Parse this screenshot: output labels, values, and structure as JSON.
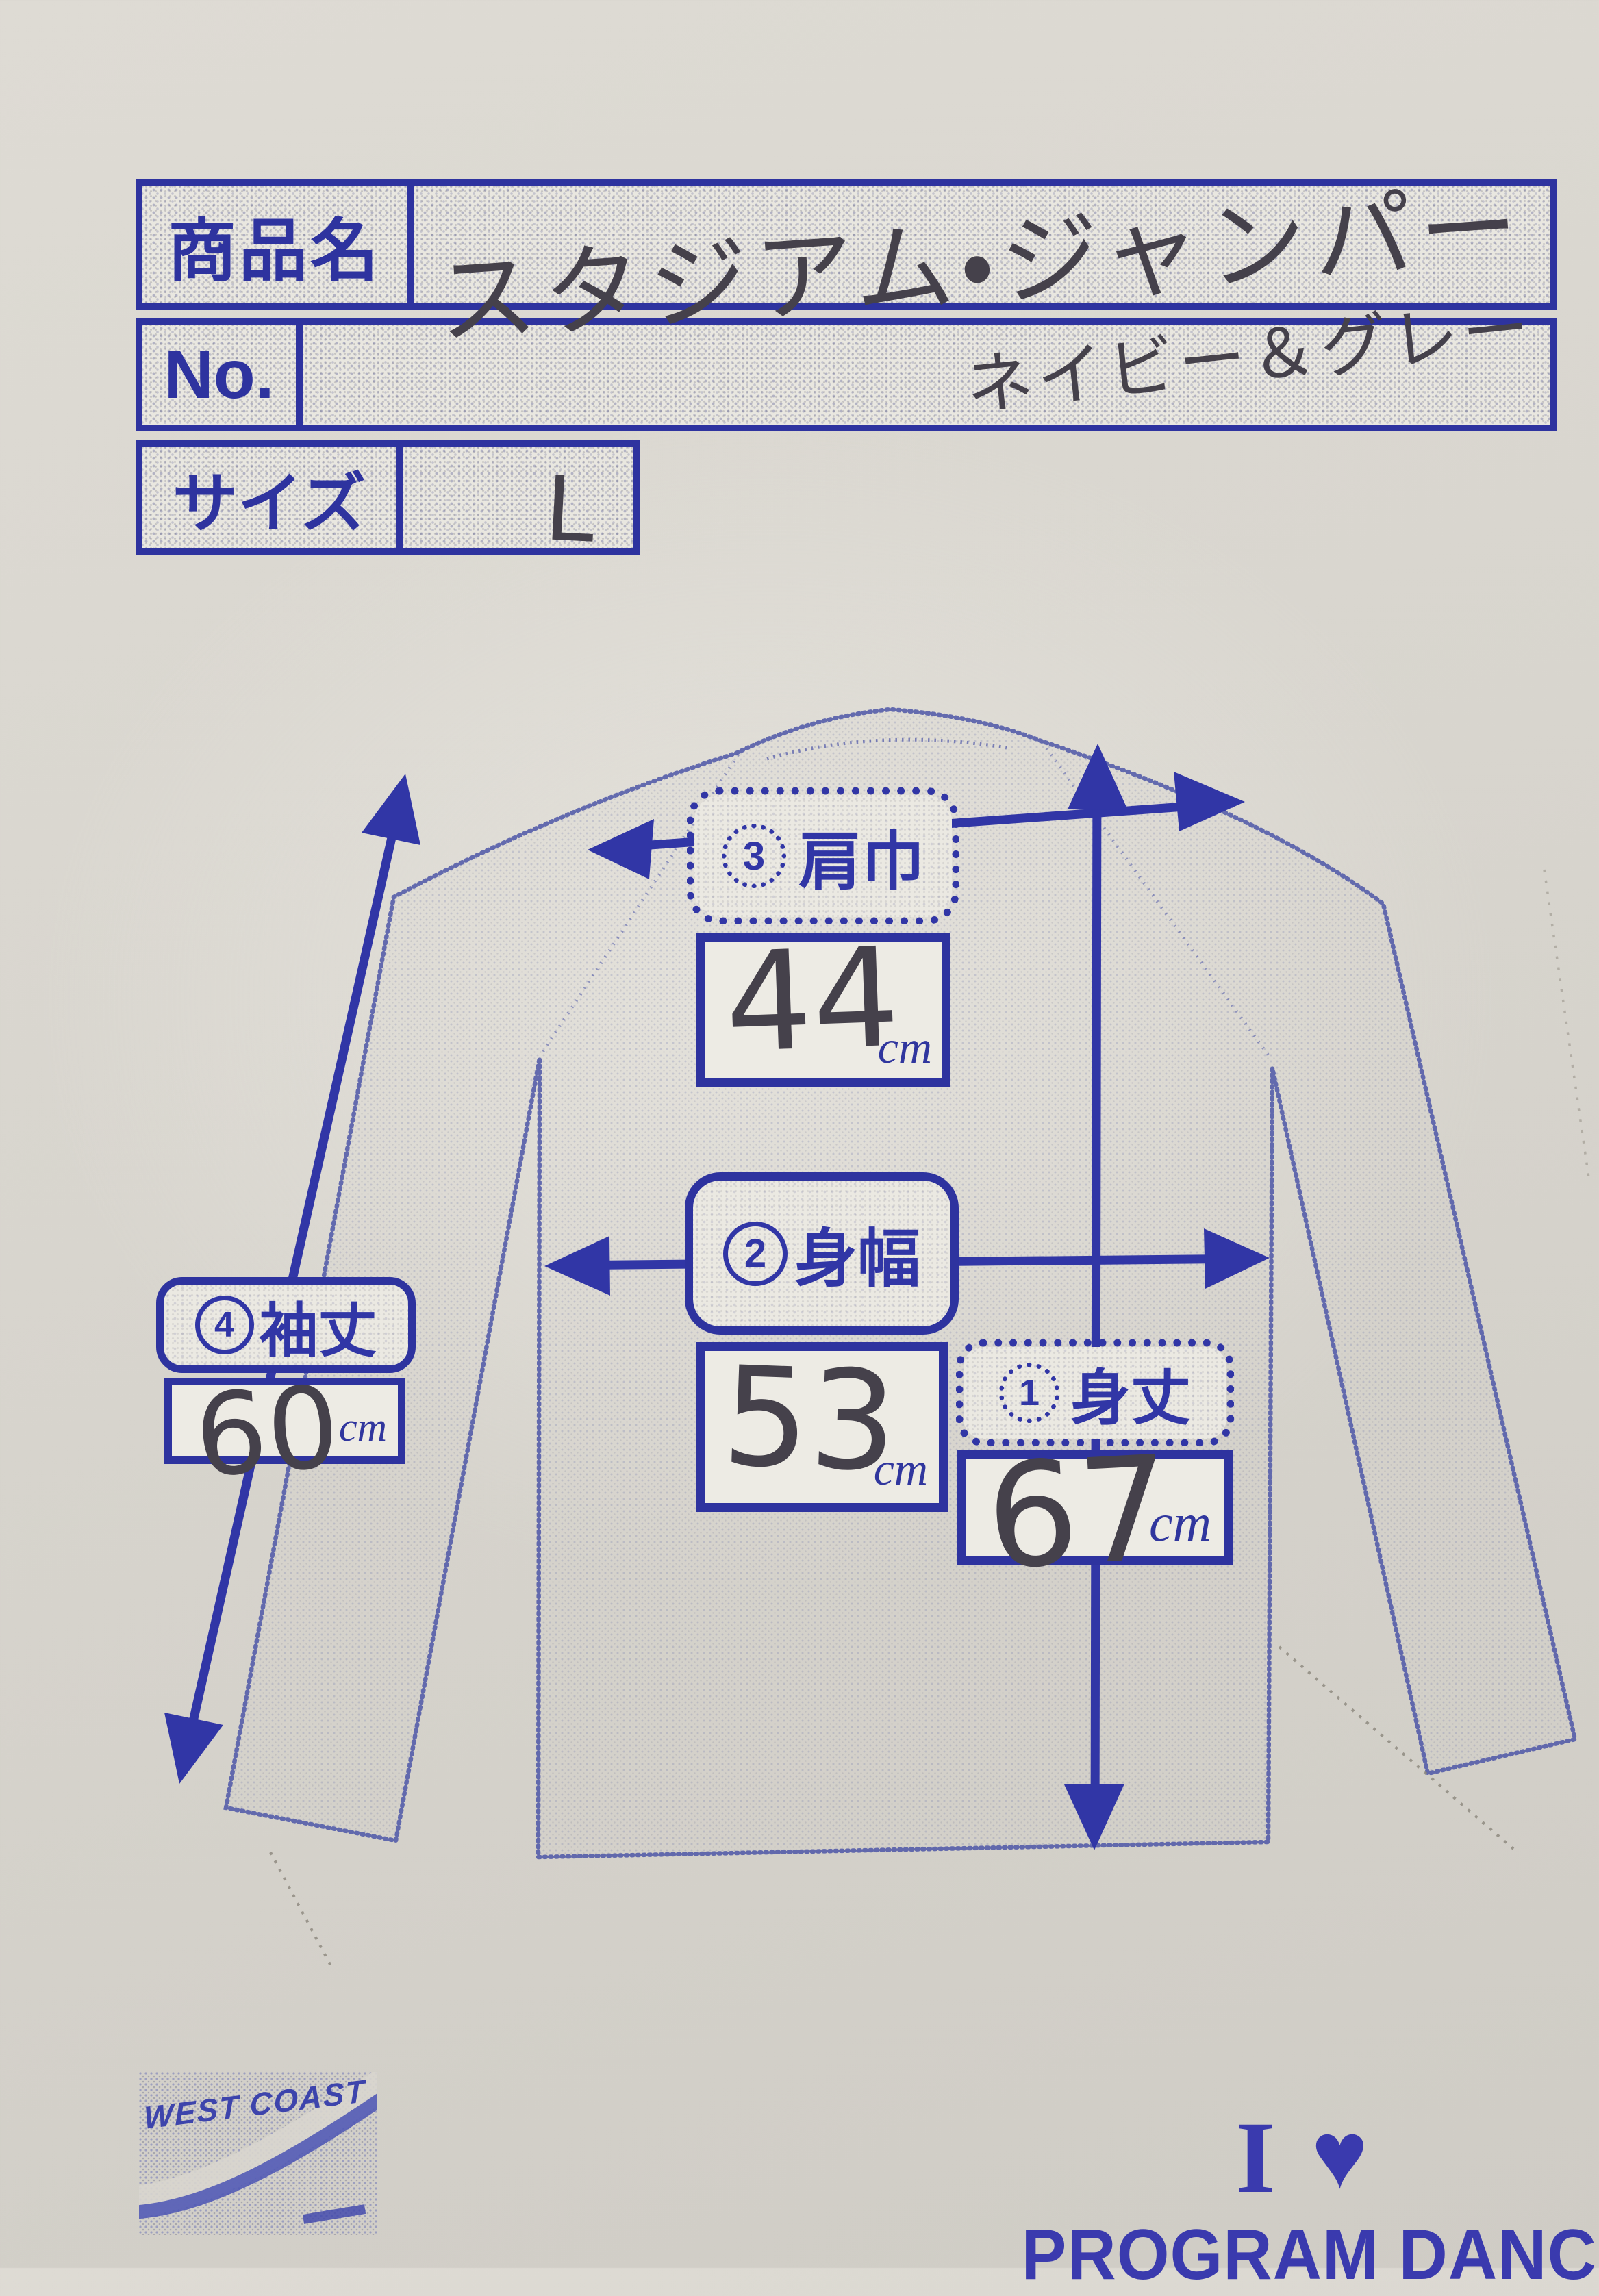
{
  "table": {
    "rows": [
      {
        "label": "商品名",
        "value": "スタジアム・ジャンパー"
      },
      {
        "label": "No.",
        "value": "ネイビー＆グレー"
      },
      {
        "label": "サイズ",
        "value": "L"
      }
    ]
  },
  "measurements": [
    {
      "index": "3",
      "name": "肩巾",
      "value": "44",
      "unit": "cm"
    },
    {
      "index": "2",
      "name": "身幅",
      "value": "53",
      "unit": "cm"
    },
    {
      "index": "1",
      "name": "身丈",
      "value": "67",
      "unit": "cm"
    },
    {
      "index": "4",
      "name": "袖丈",
      "value": "60",
      "unit": "cm"
    }
  ],
  "footer": {
    "logo": "WEST COAST",
    "love_i": "I",
    "heart": "♥",
    "love_text": "PROGRAM DANCE"
  },
  "colors": {
    "ink": "#2e339f",
    "arrow": "#3136a6",
    "handwriting": "#45414b",
    "jacket": "#5a63a8",
    "paper": "#d8d5ce"
  }
}
